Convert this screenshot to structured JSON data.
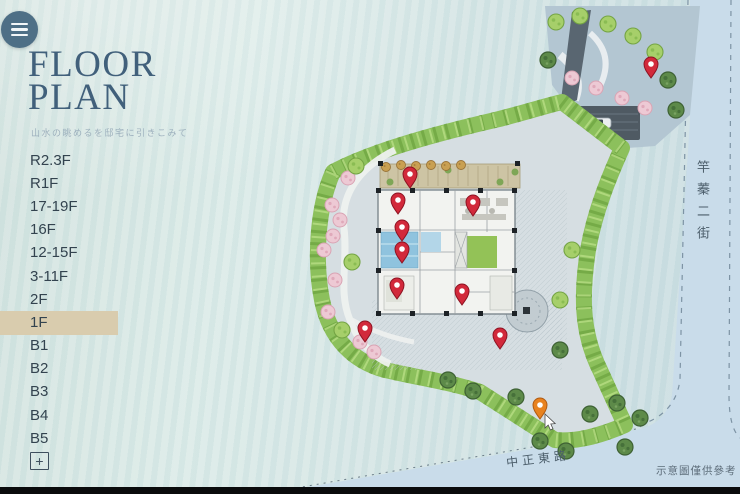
{
  "header": {
    "title_line1": "FLOOR",
    "title_line2": "PLAN",
    "subtitle": "山水の眺めるを邸宅に引きこみて"
  },
  "floor_nav": {
    "active": "1F",
    "items": [
      "R2.3F",
      "R1F",
      "17-19F",
      "16F",
      "12-15F",
      "3-11F",
      "2F",
      "1F",
      "B1",
      "B2",
      "B3",
      "B4",
      "B5"
    ]
  },
  "zoom_button": {
    "label": "+"
  },
  "map": {
    "street_right": "竿蓁二街",
    "street_bottom": "中正東路",
    "disclaimer": "示意圖僅供參考",
    "pin_colors": {
      "red": "#d2293b",
      "red_stroke": "#8e1322",
      "orange": "#e8821f",
      "orange_stroke": "#b05a10"
    },
    "pins": [
      {
        "name": "map-pin-1",
        "x": 410,
        "y": 188,
        "color": "#d2293b",
        "stroke": "#8e1322"
      },
      {
        "name": "map-pin-2",
        "x": 398,
        "y": 214,
        "color": "#d2293b",
        "stroke": "#8e1322"
      },
      {
        "name": "map-pin-3",
        "x": 473,
        "y": 216,
        "color": "#d2293b",
        "stroke": "#8e1322"
      },
      {
        "name": "map-pin-4",
        "x": 402,
        "y": 241,
        "color": "#d2293b",
        "stroke": "#8e1322"
      },
      {
        "name": "map-pin-5",
        "x": 402,
        "y": 263,
        "color": "#d2293b",
        "stroke": "#8e1322"
      },
      {
        "name": "map-pin-6",
        "x": 397,
        "y": 299,
        "color": "#d2293b",
        "stroke": "#8e1322"
      },
      {
        "name": "map-pin-7",
        "x": 462,
        "y": 305,
        "color": "#d2293b",
        "stroke": "#8e1322"
      },
      {
        "name": "map-pin-8",
        "x": 365,
        "y": 342,
        "color": "#d2293b",
        "stroke": "#8e1322"
      },
      {
        "name": "map-pin-9",
        "x": 500,
        "y": 349,
        "color": "#d2293b",
        "stroke": "#8e1322"
      },
      {
        "name": "map-pin-10",
        "x": 651,
        "y": 78,
        "color": "#d2293b",
        "stroke": "#8e1322"
      },
      {
        "name": "map-pin-selected",
        "x": 540,
        "y": 419,
        "color": "#e8821f",
        "stroke": "#b05a10"
      }
    ],
    "colors": {
      "road": "#c9dcea",
      "site_paving": "#d6dee2",
      "green_band": "#8cc05c",
      "active_highlight": "#d9ccae",
      "title": "#41607b"
    }
  }
}
